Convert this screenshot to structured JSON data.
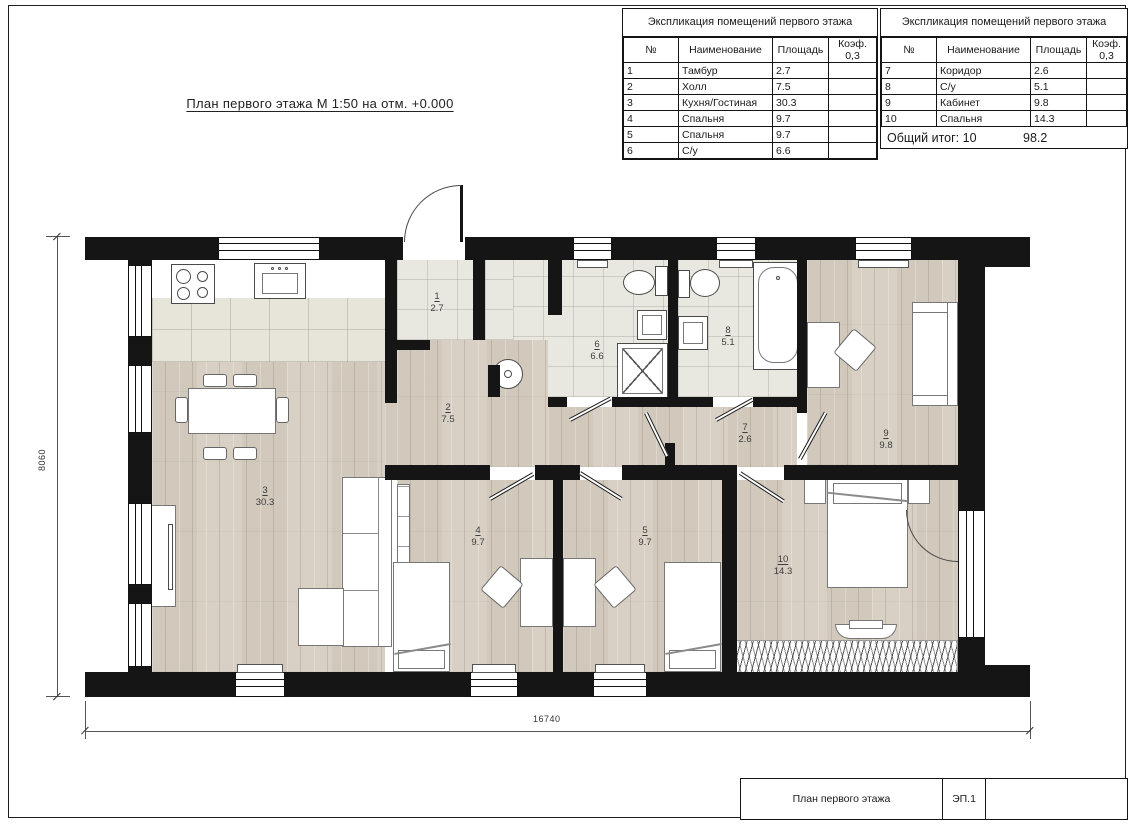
{
  "drawing_title": "План первого этажа М 1:50 на отм. +0.000",
  "explication_tables": [
    {
      "title": "Экспликация помещений первого этажа",
      "headers": [
        "№",
        "Наименование",
        "Площадь",
        "Коэф. 0,3"
      ],
      "rows": [
        [
          "1",
          "Тамбур",
          "2.7",
          ""
        ],
        [
          "2",
          "Холл",
          "7.5",
          ""
        ],
        [
          "3",
          "Кухня/Гостиная",
          "30.3",
          ""
        ],
        [
          "4",
          "Спальня",
          "9.7",
          ""
        ],
        [
          "5",
          "Спальня",
          "9.7",
          ""
        ],
        [
          "6",
          "С/у",
          "6.6",
          ""
        ]
      ]
    },
    {
      "title": "Экспликация помещений первого этажа",
      "headers": [
        "№",
        "Наименование",
        "Площадь",
        "Коэф. 0,3"
      ],
      "rows": [
        [
          "7",
          "Коридор",
          "2.6",
          ""
        ],
        [
          "8",
          "С/у",
          "5.1",
          ""
        ],
        [
          "9",
          "Кабинет",
          "9.8",
          ""
        ],
        [
          "10",
          "Спальня",
          "14.3",
          ""
        ]
      ],
      "footer": {
        "label": "Общий итог: 10",
        "total": "98.2"
      }
    }
  ],
  "plan": {
    "room_labels": [
      {
        "num": "1",
        "area": "2.7"
      },
      {
        "num": "2",
        "area": "7.5"
      },
      {
        "num": "3",
        "area": "30.3"
      },
      {
        "num": "4",
        "area": "9.7"
      },
      {
        "num": "5",
        "area": "9.7"
      },
      {
        "num": "6",
        "area": "6.6"
      },
      {
        "num": "7",
        "area": "2.6"
      },
      {
        "num": "8",
        "area": "5.1"
      },
      {
        "num": "9",
        "area": "9.8"
      },
      {
        "num": "10",
        "area": "14.3"
      }
    ],
    "dimensions": {
      "width": "16740",
      "height": "8060"
    }
  },
  "title_block": {
    "name": "План первого этажа",
    "code": "ЭП.1"
  }
}
